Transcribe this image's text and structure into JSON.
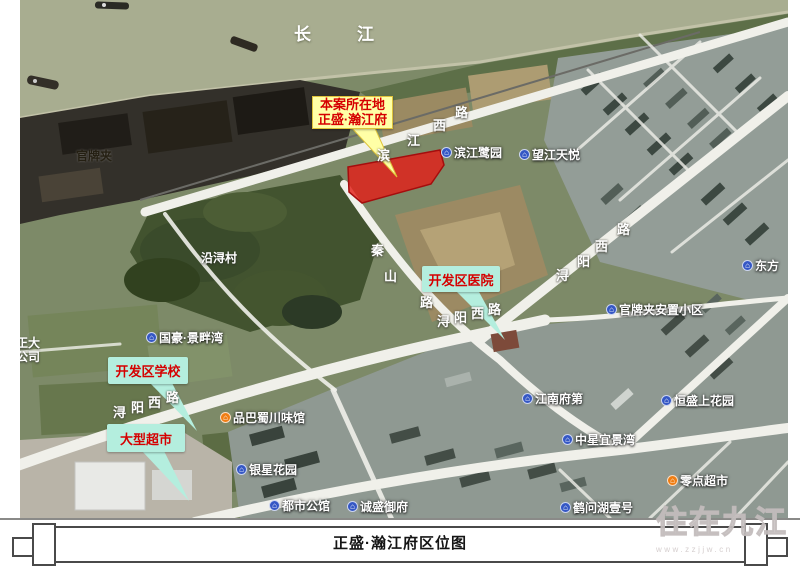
{
  "colors": {
    "river": "#a8ad90",
    "site_fill": "#e03020",
    "site_stroke": "#a50d0d",
    "callout_yellow_bg": "#ffffa6",
    "callout_yellow_border": "#dfc33a",
    "callout_teal_bg": "#b4eede",
    "callout_text_red": "#d50000",
    "poi_icon_blue": "#3457c5",
    "poi_icon_orange": "#f07d12"
  },
  "map": {
    "river_name": "长江",
    "site_callout": {
      "line1": "本案所在地",
      "line2": "正盛·瀚江府"
    },
    "callouts": [
      {
        "id": "hospital",
        "label": "开发区医院",
        "x": 422,
        "y": 266,
        "w": 78,
        "h": 26
      },
      {
        "id": "school",
        "label": "开发区学校",
        "x": 108,
        "y": 357,
        "w": 80,
        "h": 27
      },
      {
        "id": "supermarket",
        "label": "大型超市",
        "x": 107,
        "y": 424,
        "w": 78,
        "h": 28
      }
    ],
    "pois": [
      {
        "label": "滨江鹭园",
        "icon": "building",
        "x": 441,
        "y": 144
      },
      {
        "label": "望江天悦",
        "icon": "building",
        "x": 519,
        "y": 146
      },
      {
        "label": "东方",
        "icon": "building",
        "x": 742,
        "y": 257
      },
      {
        "label": "官牌夹安置小区",
        "icon": "building",
        "x": 606,
        "y": 301
      },
      {
        "label": "国豪·景畔湾",
        "icon": "building",
        "x": 146,
        "y": 329
      },
      {
        "label": "江南府第",
        "icon": "building",
        "x": 522,
        "y": 390
      },
      {
        "label": "恒盛上花园",
        "icon": "building",
        "x": 661,
        "y": 392
      },
      {
        "label": "中星宜景湾",
        "icon": "building",
        "x": 562,
        "y": 431
      },
      {
        "label": "品巴蜀川味馆",
        "icon": "restaurant",
        "x": 220,
        "y": 409
      },
      {
        "label": "银星花园",
        "icon": "building",
        "x": 236,
        "y": 461
      },
      {
        "label": "都市公馆",
        "icon": "building",
        "x": 269,
        "y": 497
      },
      {
        "label": "诚盛御府",
        "icon": "building",
        "x": 347,
        "y": 498
      },
      {
        "label": "鹤问湖壹号",
        "icon": "building",
        "x": 560,
        "y": 499
      },
      {
        "label": "零点超市",
        "icon": "shop",
        "x": 667,
        "y": 472
      }
    ],
    "area_labels": [
      {
        "text": "官牌夹",
        "x": 76,
        "y": 147,
        "cls": "dark"
      },
      {
        "text": "沿浔村",
        "x": 201,
        "y": 249,
        "cls": "light"
      }
    ],
    "clipped_label": {
      "line1": "江正大",
      "line2": "料公司"
    },
    "road_chars": [
      {
        "c": "滨",
        "x": 377,
        "y": 145
      },
      {
        "c": "江",
        "x": 407,
        "y": 130
      },
      {
        "c": "西",
        "x": 433,
        "y": 115
      },
      {
        "c": "路",
        "x": 455,
        "y": 102
      },
      {
        "c": "秦",
        "x": 371,
        "y": 240
      },
      {
        "c": "山",
        "x": 384,
        "y": 266
      },
      {
        "c": "路",
        "x": 420,
        "y": 292
      },
      {
        "c": "浔",
        "x": 113,
        "y": 402
      },
      {
        "c": "阳",
        "x": 131,
        "y": 397
      },
      {
        "c": "西",
        "x": 148,
        "y": 392
      },
      {
        "c": "路",
        "x": 166,
        "y": 387
      },
      {
        "c": "浔",
        "x": 437,
        "y": 311
      },
      {
        "c": "阳",
        "x": 454,
        "y": 307
      },
      {
        "c": "西",
        "x": 471,
        "y": 303
      },
      {
        "c": "路",
        "x": 488,
        "y": 299
      },
      {
        "c": "浔",
        "x": 556,
        "y": 265
      },
      {
        "c": "阳",
        "x": 577,
        "y": 251
      },
      {
        "c": "西",
        "x": 595,
        "y": 236
      },
      {
        "c": "路",
        "x": 617,
        "y": 219
      }
    ],
    "icon_glyphs": {
      "building": "⌂",
      "restaurant": "⌂",
      "shop": "⌂"
    }
  },
  "footer": {
    "title": "正盛·瀚江府区位图"
  },
  "watermark": {
    "text": "住在九江",
    "url": "www.zzjjw.cn"
  }
}
